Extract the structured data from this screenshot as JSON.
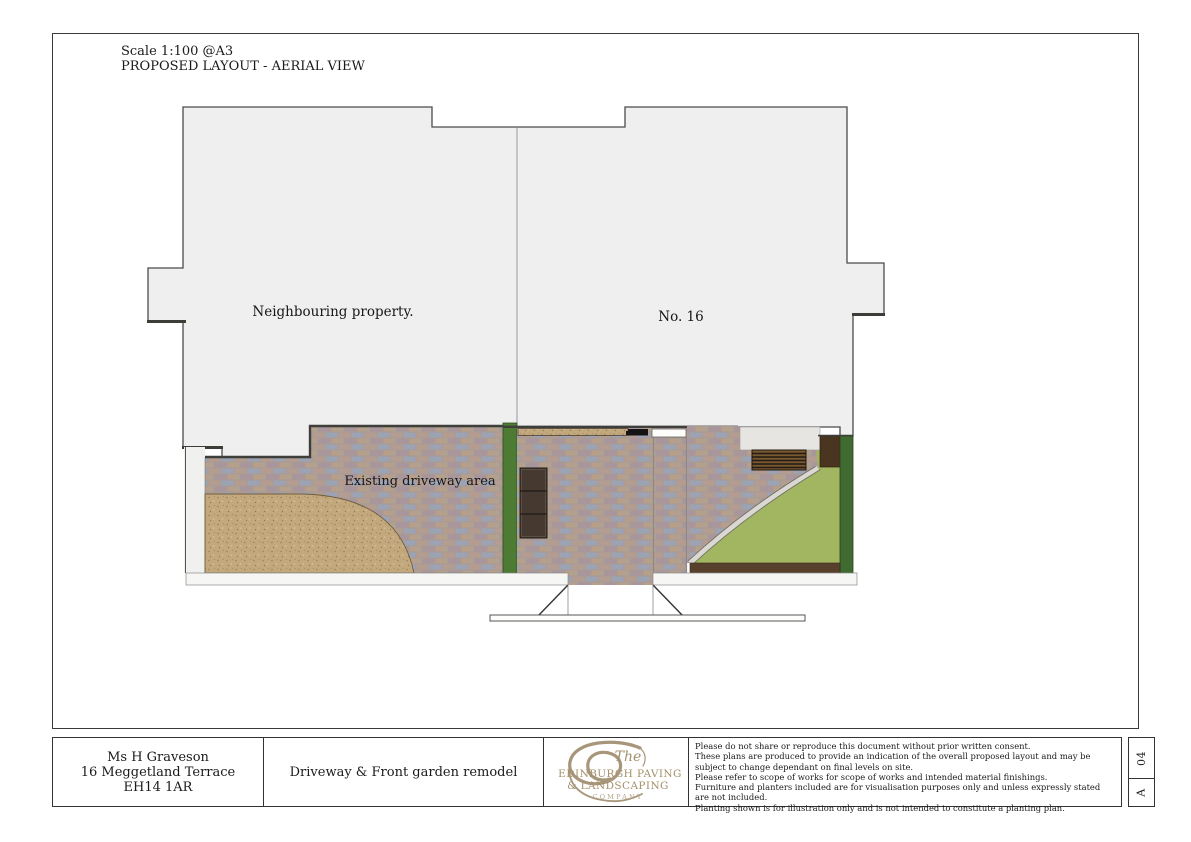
{
  "header": {
    "scale": "Scale 1:100 @A3",
    "view": "PROPOSED LAYOUT - AERIAL VIEW"
  },
  "plan": {
    "labels": {
      "neighbouring": "Neighbouring property.",
      "no16": "No. 16",
      "existing_driveway": "Existing driveway area"
    },
    "colors": {
      "building_fill": "#efeff0",
      "paving_tones": [
        "#b49c91",
        "#9ba3b4",
        "#b2a18e",
        "#a8969c",
        "#b79f8a"
      ],
      "gravel": "#c3a87d",
      "lawn": "#a2b561",
      "hedge_left": "#4d7b33",
      "hedge_right": "#3f6b31",
      "soil": "#57402c",
      "planter": "#463a30",
      "bench": "#77572f",
      "logo_tan": "#a3906c"
    }
  },
  "title_block": {
    "client": {
      "name": "Ms H Graveson",
      "address1": "16 Meggetland Terrace",
      "address2": "EH14 1AR"
    },
    "project": "Driveway & Front garden remodel",
    "logo": {
      "the": "The",
      "line1": "EDINBURGH PAVING",
      "line2": "& LANDSCAPING",
      "line3": "COMPANY"
    },
    "disclaimer": [
      "Please do not share or reproduce this document without prior written consent.",
      "These plans are produced to provide an indication of the overall proposed layout and may be subject to change dependant on final levels on site.",
      "Please refer to scope of works for scope of works and intended material finishings.",
      "Furniture and planters included are for visualisation purposes only and unless expressly stated are not included.",
      "Planting shown is for illustration only and is not intended to constitute a planting plan."
    ],
    "revision": {
      "sheet": "04",
      "rev": "A"
    }
  }
}
